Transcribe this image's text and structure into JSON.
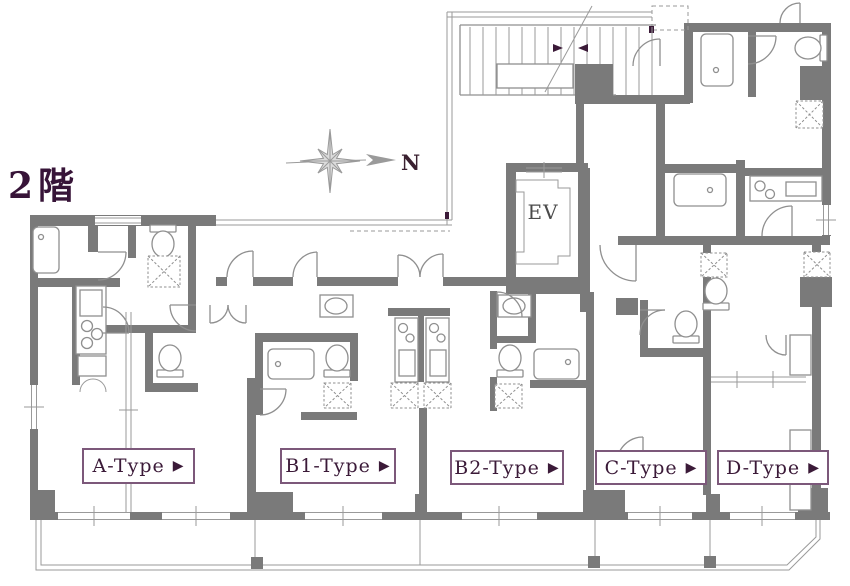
{
  "floor_label": "2階",
  "compass": {
    "label": "N"
  },
  "elevator": {
    "label": "EV"
  },
  "units": [
    {
      "id": "a-type",
      "label": "A-Type"
    },
    {
      "id": "b1-type",
      "label": "B1-Type"
    },
    {
      "id": "b2-type",
      "label": "B2-Type"
    },
    {
      "id": "c-type",
      "label": "C-Type"
    },
    {
      "id": "d-type",
      "label": "D-Type"
    }
  ],
  "unit_label_arrow": "▶",
  "colors": {
    "wall": "#7a7a7a",
    "line": "#8f8f8f",
    "label_text": "#3b1a38",
    "label_border": "#7c587a",
    "floor_text": "#371438"
  }
}
